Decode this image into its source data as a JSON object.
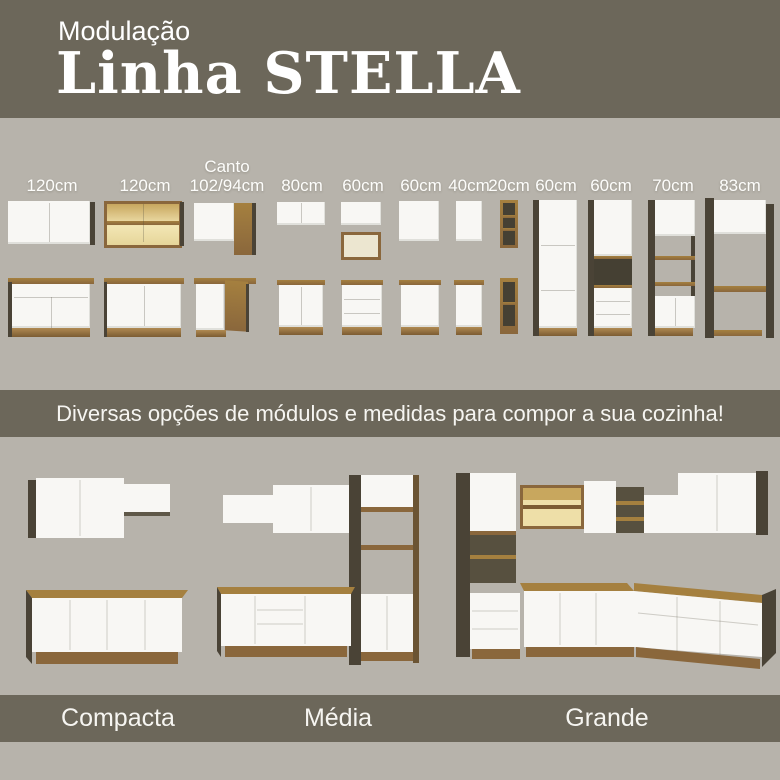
{
  "header": {
    "eyebrow": "Modulação",
    "title": "Linha STELLA"
  },
  "modules": {
    "items": [
      {
        "label": "120cm",
        "kind": "wall-cabinet-2-doors-with-base"
      },
      {
        "label": "120cm",
        "kind": "wall-cabinet-glass-doors-with-base"
      },
      {
        "label_top": "Canto",
        "label": "102/94cm",
        "kind": "corner-cabinet-with-base"
      },
      {
        "label": "80cm",
        "kind": "wall-cabinet-with-base"
      },
      {
        "label": "60cm",
        "kind": "wall-cabinet-niche-with-drawer-base"
      },
      {
        "label": "60cm",
        "kind": "wall-cabinet-with-base"
      },
      {
        "label": "40cm",
        "kind": "wall-cabinet-with-base"
      },
      {
        "label": "20cm",
        "kind": "open-shelf-column-with-base"
      },
      {
        "label": "60cm",
        "kind": "tall-pantry-tower"
      },
      {
        "label": "60cm",
        "kind": "tall-oven-tower"
      },
      {
        "label": "70cm",
        "kind": "tall-shelf-tower"
      },
      {
        "label": "83cm",
        "kind": "fridge-surround-hutch"
      }
    ]
  },
  "banner": {
    "text": "Diversas opções de módulos e medidas para compor a sua cozinha!"
  },
  "kitchens": {
    "items": [
      {
        "label": "Compacta"
      },
      {
        "label": "Média"
      },
      {
        "label": "Grande"
      }
    ]
  },
  "colors": {
    "olive": "#6c675a",
    "background": "#b7b3ab",
    "cabinet_white": "#f8f7f4",
    "wood": "#8a673c",
    "wood_light": "#a5803f",
    "panel_dark": "#4a4336",
    "glass_amber": "#eedfa8",
    "text_light": "#f6f5f1"
  }
}
